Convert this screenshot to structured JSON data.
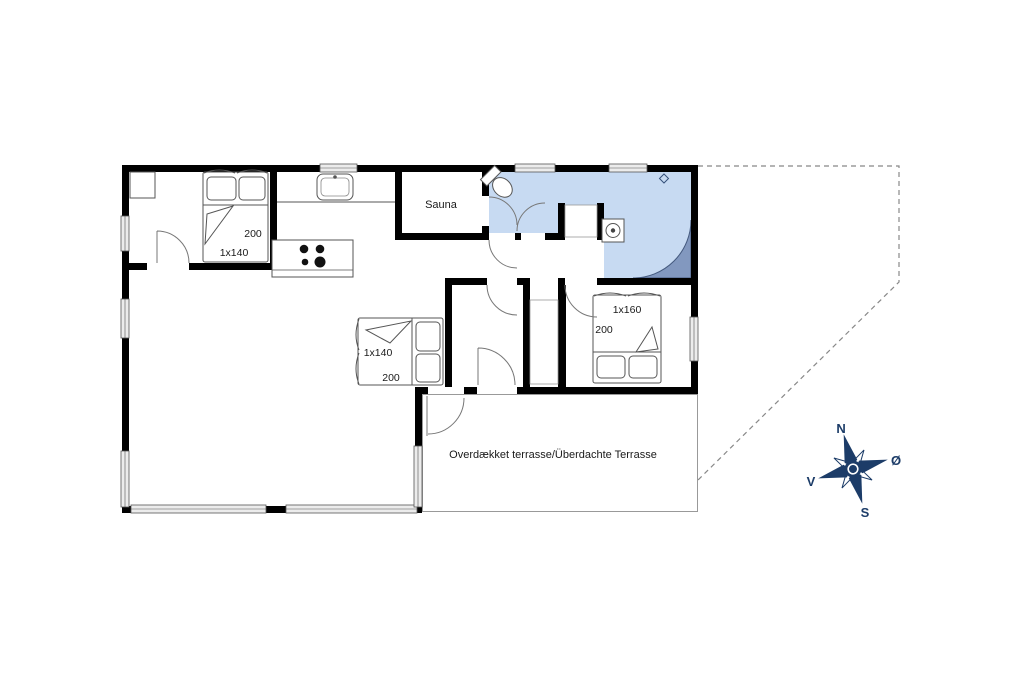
{
  "floor_plan": {
    "rooms": {
      "sauna_label": "Sauna"
    },
    "beds": {
      "bedroom1": {
        "size_label": "1x140",
        "length_label": "200"
      },
      "alcove": {
        "size_label": "1x140",
        "length_label": "200"
      },
      "bedroom2": {
        "size_label": "1x160",
        "length_label": "200"
      }
    },
    "terrace": {
      "label": "Overdækket terrasse/Überdachte Terrasse"
    },
    "compass": {
      "north": "N",
      "south": "S",
      "east": "Ø",
      "west": "V"
    },
    "colors": {
      "wall": "#000000",
      "bathroom_floor": "#c7daf2",
      "shower": "#8298bf",
      "compass": "#1c3c68",
      "window_fill": "#ececec"
    },
    "icons": {
      "compass": "compass-rose-icon",
      "toilet": "toilet-icon",
      "washer": "washing-machine-icon",
      "shower": "corner-shower-icon",
      "sink": "kitchen-sink-icon",
      "stove": "stove-burners-icon",
      "bed": "double-bed-icon"
    }
  }
}
